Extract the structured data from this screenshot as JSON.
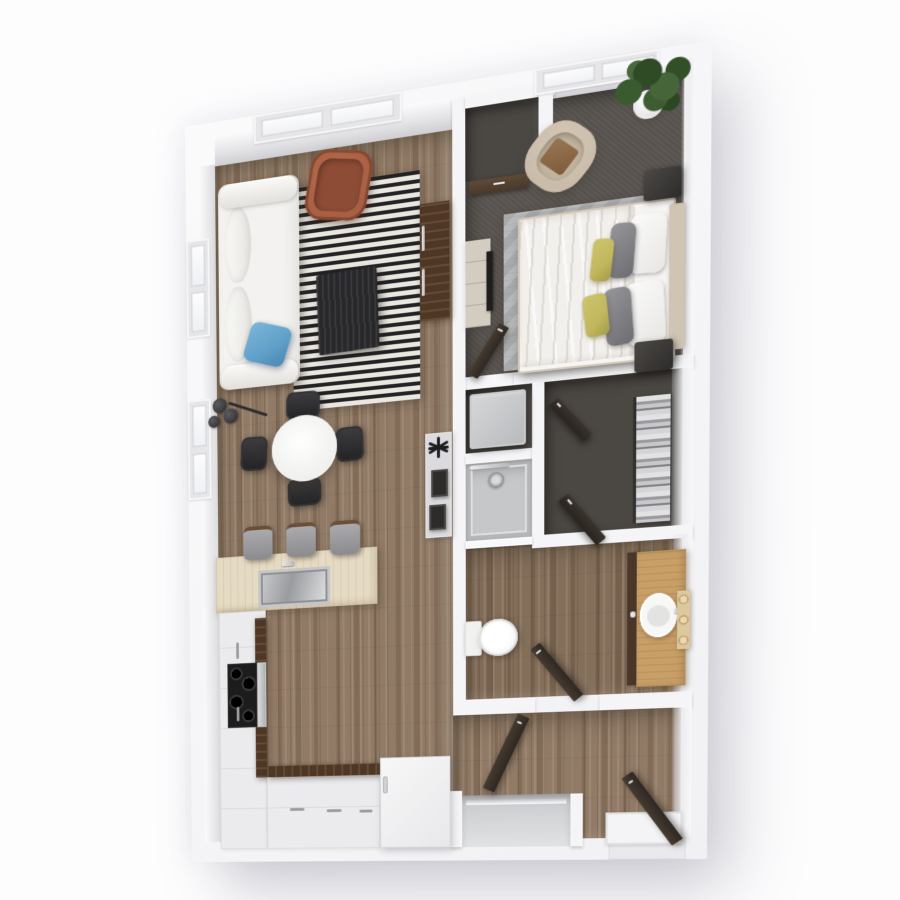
{
  "scene": {
    "background": "#fdfdfe",
    "view": "top-down-3d-floor-plan"
  },
  "palette": {
    "wood1": "#8a7460",
    "wood2": "#7c6753",
    "carpet": "#57524d",
    "darkfloor": "#4b4743",
    "rugBlack": "#232325",
    "rugCream": "#eae7e1",
    "birch": "#e5dac3",
    "walnut": "#4e3725",
    "oak": "#c89f67",
    "blue": "#5f9fc8",
    "rust": "#a85f43",
    "olive": "#c1b75f",
    "tan": "#c9bcaa",
    "tanwood": "#cfc5b2"
  },
  "plan": {
    "width": 530,
    "height": 800,
    "perspective_matrix": "matrix3d(0.85666,-0.17188,0,-0.00019336,0.014104,0.942785,0,0.000027883,0,0,1,0,185,127,0,1)",
    "items": [
      {
        "n": "building-shell",
        "c": "shell",
        "x": 0,
        "y": 0,
        "w": 530,
        "h": 800
      },
      {
        "n": "living-kitchen-floor",
        "c": "wood",
        "x": 33,
        "y": 45,
        "w": 250,
        "h": 733
      },
      {
        "n": "top-wall-face-living",
        "c": "facet",
        "x": 33,
        "y": 15,
        "w": 250,
        "h": 32
      },
      {
        "n": "entry-hall-floor",
        "c": "wood",
        "x": 283,
        "y": 648,
        "w": 222,
        "h": 130
      },
      {
        "n": "bathroom-floor",
        "c": "woodd",
        "x": 296,
        "y": 476,
        "w": 209,
        "h": 156
      },
      {
        "n": "bedroom-carpet",
        "c": "carpet",
        "x": 296,
        "y": 30,
        "w": 209,
        "h": 270
      },
      {
        "n": "top-wall-face-bedroom",
        "c": "facet",
        "x": 296,
        "y": 15,
        "w": 209,
        "h": 17
      },
      {
        "n": "laundry-niche-floor",
        "c": "darkfloor",
        "x": 296,
        "y": 313,
        "w": 66,
        "h": 65
      },
      {
        "n": "shower-pan",
        "c": "shower",
        "x": 296,
        "y": 389,
        "w": 66,
        "h": 79
      },
      {
        "n": "walkin-closet-floor",
        "c": "darkfloor",
        "x": 374,
        "y": 313,
        "w": 131,
        "h": 154
      },
      {
        "n": "bedroom-closet-floor",
        "c": "darkfloor",
        "x": 296,
        "y": 28,
        "w": 74,
        "h": 74
      },
      {
        "n": "divider-wall",
        "c": "wall",
        "x": 283,
        "y": 15,
        "w": 13,
        "h": 633
      },
      {
        "n": "bedroom-south-wall",
        "c": "wall",
        "x": 344,
        "y": 300,
        "w": 171,
        "h": 13
      },
      {
        "n": "bedroom-closet-top-wall",
        "c": "wall",
        "x": 296,
        "y": 15,
        "w": 88,
        "h": 13
      },
      {
        "n": "bedroom-closet-right-wall",
        "c": "wall",
        "x": 368,
        "y": 15,
        "w": 14,
        "h": 89
      },
      {
        "n": "niche-shower-wall",
        "c": "wall",
        "x": 296,
        "y": 378,
        "w": 66,
        "h": 11
      },
      {
        "n": "closet-west-wall",
        "c": "wall",
        "x": 362,
        "y": 313,
        "w": 12,
        "h": 167
      },
      {
        "n": "closet-south-wall",
        "c": "wall",
        "x": 362,
        "y": 467,
        "w": 153,
        "h": 13
      },
      {
        "n": "bath-south-wall-west",
        "c": "wall",
        "x": 283,
        "y": 632,
        "w": 82,
        "h": 16
      },
      {
        "n": "bath-south-wall-east",
        "c": "wall",
        "x": 428,
        "y": 632,
        "w": 87,
        "h": 16
      },
      {
        "n": "entry-closet-left-wall",
        "c": "wall",
        "x": 280,
        "y": 727,
        "w": 12,
        "h": 59
      },
      {
        "n": "entry-closet-right-wall",
        "c": "wall",
        "x": 400,
        "y": 732,
        "w": 12,
        "h": 54
      },
      {
        "n": "right-wall-face-bedroom",
        "c": "facetR",
        "x": 503,
        "y": 15,
        "w": 12,
        "h": 285
      },
      {
        "n": "right-wall-face-closet",
        "c": "facetR",
        "x": 495,
        "y": 313,
        "w": 20,
        "h": 154
      },
      {
        "n": "right-wall-face-bath",
        "c": "facetR",
        "x": 497,
        "y": 476,
        "w": 18,
        "h": 156
      },
      {
        "n": "right-wall-face-hall",
        "c": "facetR",
        "x": 497,
        "y": 648,
        "w": 18,
        "h": 130
      },
      {
        "n": "left-wall-face",
        "c": "facetL",
        "x": 15,
        "y": 45,
        "w": 18,
        "h": 733
      },
      {
        "n": "living-window-frame",
        "c": "winframe",
        "x": 76,
        "y": 0,
        "w": 156,
        "h": 30
      },
      {
        "n": "living-window-pane-1",
        "c": "winpane",
        "x": 84,
        "y": 6,
        "w": 66,
        "h": 18
      },
      {
        "n": "living-window-pane-2",
        "c": "winpane",
        "x": 158,
        "y": 6,
        "w": 66,
        "h": 18
      },
      {
        "n": "bedroom-window-frame",
        "c": "winframe",
        "x": 364,
        "y": 0,
        "w": 118,
        "h": 26
      },
      {
        "n": "bedroom-window-pane-1",
        "c": "winpane",
        "x": 372,
        "y": 5,
        "w": 50,
        "h": 16
      },
      {
        "n": "bedroom-window-pane-2",
        "c": "winpane",
        "x": 428,
        "y": 5,
        "w": 50,
        "h": 16
      },
      {
        "n": "side-window-upper-frame",
        "c": "winframe",
        "x": 0,
        "y": 122,
        "w": 26,
        "h": 105
      },
      {
        "n": "side-window-upper-pane-1",
        "c": "winpane",
        "x": 5,
        "y": 128,
        "w": 16,
        "h": 44
      },
      {
        "n": "side-window-upper-pane-2",
        "c": "winpane",
        "x": 5,
        "y": 178,
        "w": 16,
        "h": 43
      },
      {
        "n": "side-window-lower-frame",
        "c": "winframe",
        "x": 0,
        "y": 294,
        "w": 26,
        "h": 108
      },
      {
        "n": "side-window-lower-pane-1",
        "c": "winpane",
        "x": 5,
        "y": 300,
        "w": 16,
        "h": 45
      },
      {
        "n": "side-window-lower-pane-2",
        "c": "winpane",
        "x": 5,
        "y": 352,
        "w": 16,
        "h": 44
      },
      {
        "n": "striped-rug",
        "c": "rug",
        "x": 117,
        "y": 83,
        "w": 133,
        "h": 234
      },
      {
        "n": "sofa",
        "c": "sofa",
        "x": 36,
        "y": 68,
        "w": 88,
        "h": 219
      },
      {
        "n": "sofa-back-cushion-1",
        "c": "sofac",
        "x": 42,
        "y": 94,
        "w": 30,
        "h": 80
      },
      {
        "n": "sofa-back-cushion-2",
        "c": "sofac",
        "x": 42,
        "y": 178,
        "w": 30,
        "h": 80
      },
      {
        "n": "sofa-armrest-top",
        "c": "sofaa",
        "x": 38,
        "y": 68,
        "w": 84,
        "h": 26
      },
      {
        "n": "sofa-armrest-bottom",
        "c": "sofaa",
        "x": 38,
        "y": 261,
        "w": 84,
        "h": 26
      },
      {
        "n": "blue-pillow",
        "c": "bluepil",
        "x": 66,
        "y": 222,
        "w": 46,
        "h": 42,
        "r": 18
      },
      {
        "n": "floor-lamp-disc-1",
        "c": "disc",
        "x": 28,
        "y": 295,
        "w": 16,
        "h": 16
      },
      {
        "n": "floor-lamp-disc-2",
        "c": "disc",
        "x": 40,
        "y": 307,
        "w": 16,
        "h": 16
      },
      {
        "n": "floor-lamp-disc-3",
        "c": "disc",
        "x": 23,
        "y": 313,
        "w": 13,
        "h": 13
      },
      {
        "n": "floor-lamp-arm",
        "c": "larm",
        "x": 44,
        "y": 308,
        "w": 46,
        "h": 3,
        "r": 22
      },
      {
        "n": "coffee-table",
        "c": "ctable",
        "x": 143,
        "y": 176,
        "w": 64,
        "h": 84,
        "r": -2
      },
      {
        "n": "lounge-chair-rust",
        "c": "armch",
        "x": 133,
        "y": 50,
        "w": 66,
        "h": 72,
        "r": 10
      },
      {
        "n": "lounge-chair-cushion",
        "c": "armchi",
        "x": 142,
        "y": 59,
        "w": 48,
        "h": 54,
        "r": 10
      },
      {
        "n": "media-console",
        "c": "walnut",
        "x": 250,
        "y": 118,
        "w": 30,
        "h": 120
      },
      {
        "n": "console-handle-1",
        "c": "chrome",
        "x": 252,
        "y": 140,
        "w": 3,
        "h": 26
      },
      {
        "n": "console-handle-2",
        "c": "chrome",
        "x": 252,
        "y": 184,
        "w": 3,
        "h": 28
      },
      {
        "n": "hallway-console",
        "c": "panel",
        "x": 255,
        "y": 354,
        "w": 27,
        "h": 108
      },
      {
        "n": "decor-star-bar-1",
        "c": "starbar",
        "x": 267,
        "y": 358,
        "w": 3,
        "h": 22
      },
      {
        "n": "decor-star-bar-2",
        "c": "starbar",
        "x": 267,
        "y": 358,
        "w": 3,
        "h": 22,
        "r": 62
      },
      {
        "n": "decor-star-bar-3",
        "c": "starbar",
        "x": 267,
        "y": 358,
        "w": 3,
        "h": 22,
        "r": -62
      },
      {
        "n": "decor-star-bar-4",
        "c": "starbar",
        "x": 258,
        "y": 368,
        "w": 21,
        "h": 3
      },
      {
        "n": "photo-frame-1",
        "c": "pframe",
        "x": 261,
        "y": 392,
        "w": 17,
        "h": 28
      },
      {
        "n": "photo-frame-2",
        "c": "pframe",
        "x": 259,
        "y": 428,
        "w": 17,
        "h": 26
      },
      {
        "n": "dining-chair-north",
        "c": "dchair",
        "x": 109,
        "y": 297,
        "w": 36,
        "h": 29,
        "r": 2
      },
      {
        "n": "dining-chair-south",
        "c": "dchair",
        "x": 110,
        "y": 389,
        "w": 36,
        "h": 29,
        "r": -2
      },
      {
        "n": "dining-chair-west",
        "c": "dchairV",
        "x": 59,
        "y": 340,
        "w": 29,
        "h": 36,
        "r": 3
      },
      {
        "n": "dining-chair-east",
        "c": "dchairV",
        "x": 162,
        "y": 339,
        "w": 29,
        "h": 36,
        "r": -3
      },
      {
        "n": "dining-table",
        "c": "dtable",
        "x": 93,
        "y": 322,
        "w": 70,
        "h": 70
      },
      {
        "n": "kitchen-island",
        "c": "birch",
        "x": 30,
        "y": 467,
        "w": 175,
        "h": 60
      },
      {
        "n": "island-sink",
        "c": "ksink",
        "x": 77,
        "y": 484,
        "w": 78,
        "h": 40
      },
      {
        "n": "island-faucet",
        "c": "chrome",
        "x": 103,
        "y": 476,
        "w": 14,
        "h": 5
      },
      {
        "n": "bar-stool-1",
        "c": "stool",
        "x": 61,
        "y": 436,
        "w": 32,
        "h": 32
      },
      {
        "n": "bar-stool-2",
        "c": "stool",
        "x": 108,
        "y": 436,
        "w": 32,
        "h": 32
      },
      {
        "n": "bar-stool-3",
        "c": "stool",
        "x": 155,
        "y": 437,
        "w": 32,
        "h": 32
      },
      {
        "n": "counter-west",
        "c": "whitecab",
        "x": 33,
        "y": 527,
        "w": 52,
        "h": 259
      },
      {
        "n": "counter-west-edge",
        "c": "walnut",
        "x": 73,
        "y": 535,
        "w": 12,
        "h": 173
      },
      {
        "n": "range-cooktop",
        "c": "stoveblk",
        "x": 42,
        "y": 583,
        "w": 33,
        "h": 70
      },
      {
        "n": "range-front",
        "c": "chromeband",
        "x": 75,
        "y": 583,
        "w": 10,
        "h": 70
      },
      {
        "n": "cabinet-handle-1",
        "c": "cabhandle",
        "x": 52,
        "y": 560,
        "w": 3,
        "h": 18
      },
      {
        "n": "cabinet-handle-2",
        "c": "cabhandle",
        "x": 52,
        "y": 630,
        "w": 3,
        "h": 16
      },
      {
        "n": "counter-south",
        "c": "whitecab",
        "x": 85,
        "y": 696,
        "w": 122,
        "h": 90
      },
      {
        "n": "counter-south-edge",
        "c": "walnutH",
        "x": 85,
        "y": 696,
        "w": 122,
        "h": 12
      },
      {
        "n": "cabinet-handle-3",
        "c": "cabhandleH",
        "x": 110,
        "y": 742,
        "w": 16,
        "h": 3
      },
      {
        "n": "cabinet-handle-4",
        "c": "cabhandleH",
        "x": 150,
        "y": 744,
        "w": 16,
        "h": 3
      },
      {
        "n": "cabinet-handle-5",
        "c": "cabhandleH",
        "x": 185,
        "y": 745,
        "w": 14,
        "h": 3
      },
      {
        "n": "appliance-cabinet",
        "c": "whitebox",
        "x": 207,
        "y": 690,
        "w": 73,
        "h": 96
      },
      {
        "n": "appliance-handle",
        "c": "pillh",
        "x": 210,
        "y": 710,
        "w": 5,
        "h": 18
      },
      {
        "n": "entry-closet-interior",
        "c": "rc",
        "x": 292,
        "y": 732,
        "w": 108,
        "h": 54
      },
      {
        "n": "entry-closet-track",
        "c": "track",
        "x": 296,
        "y": 737,
        "w": 100,
        "h": 5
      },
      {
        "n": "hall-door-open",
        "c": "doorleaf",
        "x": 312,
        "y": 643,
        "w": 13,
        "h": 84,
        "r": 25,
        "o": "50% 100%"
      },
      {
        "n": "entry-threshold",
        "c": "thresh",
        "x": 437,
        "y": 778,
        "w": 73,
        "h": 22
      },
      {
        "n": "entry-landing",
        "c": "landing",
        "x": 434,
        "y": 752,
        "w": 73,
        "h": 33
      },
      {
        "n": "entry-door-open",
        "c": "doorleaf",
        "x": 496,
        "y": 699,
        "w": 13,
        "h": 84,
        "r": -35,
        "o": "50% 100%"
      },
      {
        "n": "bedroom-closet-door",
        "c": "nookdoor",
        "x": 300,
        "y": 102,
        "w": 58,
        "h": 14
      },
      {
        "n": "bed-rug",
        "c": "bedrug",
        "x": 334,
        "y": 140,
        "w": 138,
        "h": 158
      },
      {
        "n": "bed",
        "c": "bedbase",
        "x": 348,
        "y": 146,
        "w": 146,
        "h": 152
      },
      {
        "n": "duvet",
        "c": "duvet",
        "x": 350,
        "y": 148,
        "w": 110,
        "h": 148
      },
      {
        "n": "pillow-white-1",
        "c": "pilw",
        "x": 455,
        "y": 158,
        "w": 34,
        "h": 58,
        "r": 3
      },
      {
        "n": "pillow-white-2",
        "c": "pilw",
        "x": 452,
        "y": 224,
        "w": 36,
        "h": 62,
        "r": -3
      },
      {
        "n": "pillow-grey-1",
        "c": "pilg",
        "x": 436,
        "y": 164,
        "w": 24,
        "h": 54,
        "r": 4
      },
      {
        "n": "pillow-grey-2",
        "c": "pilg",
        "x": 432,
        "y": 227,
        "w": 26,
        "h": 57,
        "r": -4
      },
      {
        "n": "pillow-olive-1",
        "c": "pily",
        "x": 419,
        "y": 177,
        "w": 20,
        "h": 42,
        "r": 6
      },
      {
        "n": "pillow-olive-2",
        "c": "pily",
        "x": 412,
        "y": 231,
        "w": 23,
        "h": 42,
        "r": -6
      },
      {
        "n": "headboard",
        "c": "hboard",
        "x": 492,
        "y": 152,
        "w": 14,
        "h": 142
      },
      {
        "n": "nightstand-north",
        "c": "nstand",
        "x": 468,
        "y": 116,
        "w": 35,
        "h": 30
      },
      {
        "n": "nightstand-south",
        "c": "nstand",
        "x": 460,
        "y": 283,
        "w": 36,
        "h": 30
      },
      {
        "n": "dresser",
        "c": "dresser",
        "x": 296,
        "y": 162,
        "w": 25,
        "h": 88
      },
      {
        "n": "dresser-tv",
        "c": "tvslab",
        "x": 317,
        "y": 175,
        "w": 6,
        "h": 60
      },
      {
        "n": "accent-chair-tan",
        "c": "tanch",
        "x": 358,
        "y": 56,
        "w": 62,
        "h": 68,
        "r": 40
      },
      {
        "n": "accent-chair-cushion",
        "c": "tanchi",
        "x": 369,
        "y": 67,
        "w": 40,
        "h": 46,
        "r": 40
      },
      {
        "n": "accent-chair-seat",
        "c": "tanchw",
        "x": 374,
        "y": 76,
        "w": 28,
        "h": 28,
        "r": 40
      },
      {
        "n": "plant-pot",
        "c": "pot",
        "x": 458,
        "y": 38,
        "w": 28,
        "h": 28
      },
      {
        "n": "plant-foliage",
        "c": "foliage",
        "x": 437,
        "y": 2,
        "w": 76,
        "h": 64
      },
      {
        "n": "bedroom-door-open",
        "c": "doorleaf",
        "x": 297,
        "y": 242,
        "w": 12,
        "h": 58,
        "r": 33,
        "o": "50% 100%"
      },
      {
        "n": "closet-rod",
        "c": "rodline",
        "x": 459,
        "y": 337,
        "w": 3,
        "h": 125
      },
      {
        "n": "hanging-clothes",
        "c": "clothes",
        "x": 462,
        "y": 337,
        "w": 32,
        "h": 125
      },
      {
        "n": "closet-door-1",
        "c": "doorleafH",
        "x": 387,
        "y": 330,
        "w": 52,
        "h": 11,
        "r": 50,
        "o": "0 0"
      },
      {
        "n": "closet-door-2",
        "c": "doorleafH",
        "x": 397,
        "y": 427,
        "w": 60,
        "h": 12,
        "r": 52,
        "o": "0 0"
      },
      {
        "n": "washer-dryer",
        "c": "washer",
        "x": 300,
        "y": 318,
        "w": 56,
        "h": 56
      },
      {
        "n": "shower-bar",
        "c": "chrome",
        "x": 300,
        "y": 391,
        "w": 40,
        "h": 4
      },
      {
        "n": "shower-head",
        "c": "showerhead",
        "x": 319,
        "y": 400,
        "w": 15,
        "h": 15
      },
      {
        "n": "shower-glass",
        "c": "glass",
        "x": 296,
        "y": 468,
        "w": 66,
        "h": 8
      },
      {
        "n": "toilet-tank",
        "c": "tank",
        "x": 295,
        "y": 551,
        "w": 17,
        "h": 36
      },
      {
        "n": "toilet-bowl",
        "c": "bowl",
        "x": 309,
        "y": 550,
        "w": 39,
        "h": 38
      },
      {
        "n": "bathroom-door-open",
        "c": "doorleaf",
        "x": 402,
        "y": 565,
        "w": 12,
        "h": 70,
        "r": -38,
        "o": "50% 100%"
      },
      {
        "n": "vanity-side-panel",
        "c": "vdark",
        "x": 454,
        "y": 491,
        "w": 10,
        "h": 133
      },
      {
        "n": "vanity-counter",
        "c": "oak",
        "x": 463,
        "y": 491,
        "w": 46,
        "h": 135
      },
      {
        "n": "vanity-sink",
        "c": "sinko",
        "x": 466,
        "y": 533,
        "w": 35,
        "h": 44
      },
      {
        "n": "vanity-faucet",
        "c": "chrome",
        "x": 498,
        "y": 549,
        "w": 8,
        "h": 5
      },
      {
        "n": "towel-peg-board",
        "c": "tboard",
        "x": 501,
        "y": 532,
        "w": 12,
        "h": 58
      }
    ]
  }
}
